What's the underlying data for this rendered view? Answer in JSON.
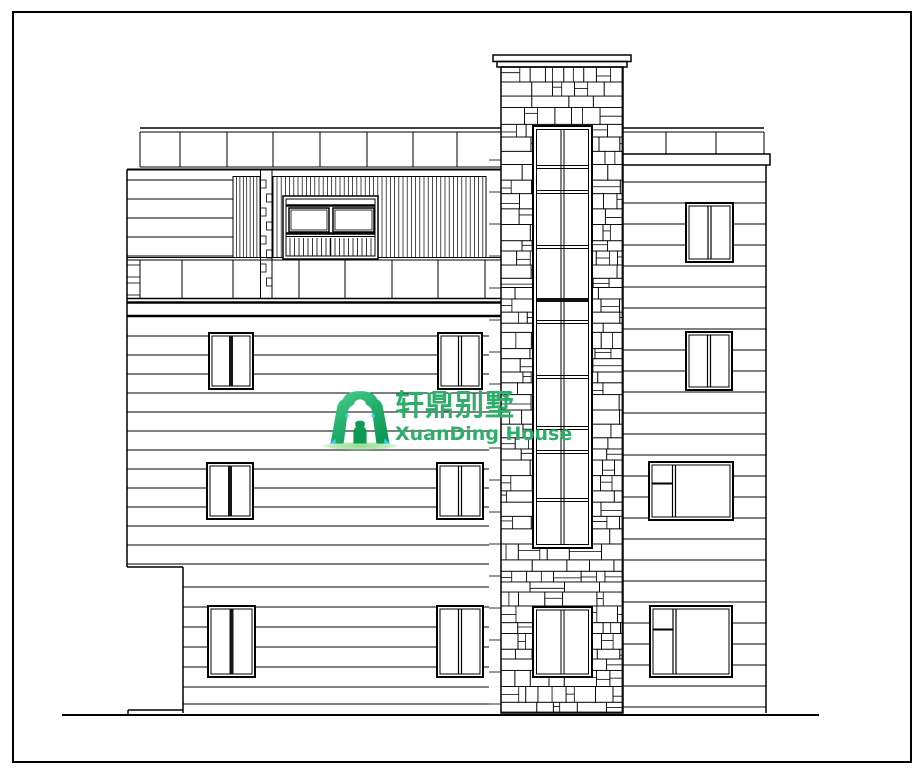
{
  "watermark": {
    "icon": "xuanding-gate-icon",
    "brand_cn": "轩鼎别墅",
    "brand_en": "XuanDing House",
    "text_green": "#2fae6a",
    "green_light": "#4ed08e",
    "green_mid": "#24b26e",
    "green_dark": "#0e9a55",
    "accent_cyan": "#45c8e8",
    "swoosh_green": "#90dc8e"
  },
  "drawing": {
    "ink": "#000000",
    "paper": "#ffffff"
  }
}
